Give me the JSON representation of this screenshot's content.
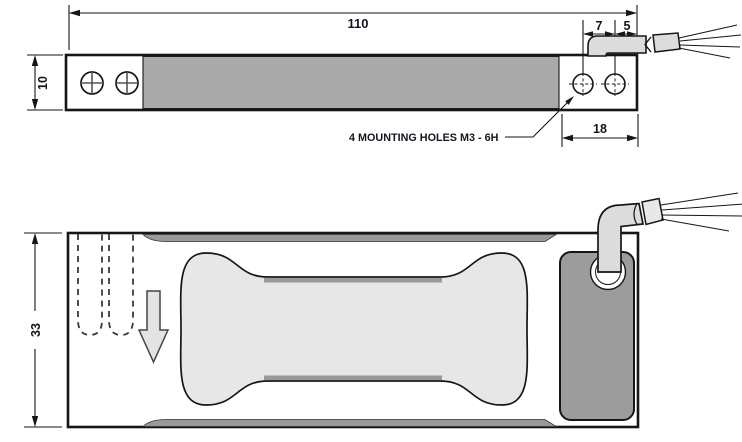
{
  "drawing": {
    "side_view": {
      "dim_overall_length": "110",
      "dim_height": "10",
      "dim_hole_pitch": "7",
      "dim_hole_edge": "5",
      "dim_end_block": "18",
      "mounting_note": "4 MOUNTING HOLES  M3 - 6H"
    },
    "plan_view": {
      "dim_width": "33"
    },
    "colors": {
      "outline": "#161616",
      "body_gray": "#a9a9a9",
      "strip_gray": "#999999",
      "pocket_gray": "#e7e7e7",
      "cable_gray": "#dcdcdc",
      "plate_gray": "#9c9c9c",
      "arrow_gray": "#e3e3e3"
    }
  }
}
